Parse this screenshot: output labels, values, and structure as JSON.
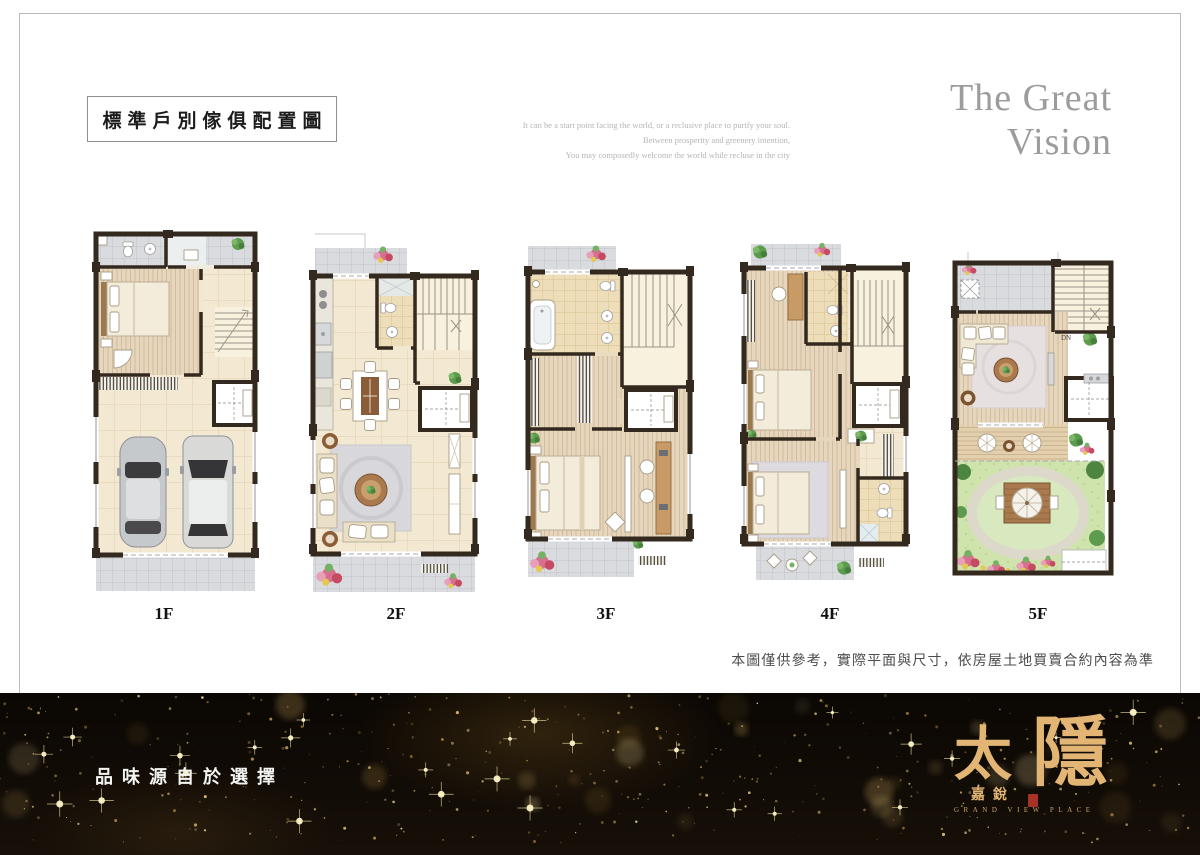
{
  "header": {
    "title": "標準戶別傢俱配置圖",
    "brand_line1": "The Great",
    "brand_line2": "Vision",
    "tagline_lines": [
      "It can be a start point facing the world, or a reclusive place to purify your soul.",
      "Between prosperity and greenery intention,",
      "You may composedly welcome the world while recluse in the city"
    ]
  },
  "plans": [
    {
      "label": "1F"
    },
    {
      "label": "2F"
    },
    {
      "label": "3F"
    },
    {
      "label": "4F"
    },
    {
      "label": "5F",
      "stair_note": "DN"
    }
  ],
  "footer": {
    "disclaimer": "本圖僅供參考，實際平面與尺寸，依房屋土地買賣合約內容為準"
  },
  "banner": {
    "slogan": "品味源自於選擇",
    "logo_char1": "太",
    "logo_char2": "隱",
    "logo_sub": "嘉銳",
    "logo_en": "GRAND VIEW PLACE",
    "sparkle_colors": [
      "#e8c06a",
      "#c89b4a",
      "#f6e3a0",
      "#8a6a2f",
      "#f0d080"
    ]
  },
  "colors": {
    "logo_gold": "#e2b574",
    "seal_red": "#a93226",
    "brand_gray": "#9c9c9c"
  }
}
